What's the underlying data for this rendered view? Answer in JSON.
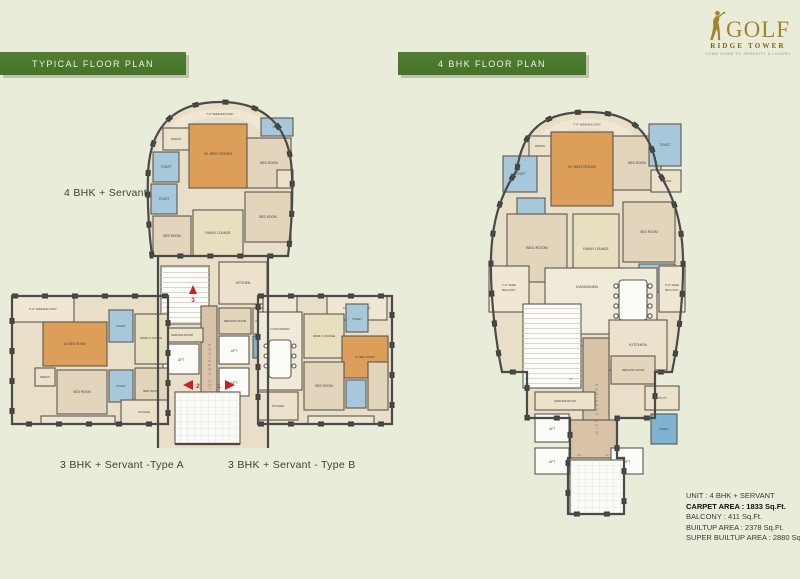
{
  "brand": {
    "title": "GOLF",
    "subtitle": "RIDGE TOWER",
    "tagline": "COME HOME TO SERENITY & LUXURY"
  },
  "headers": {
    "typical": "TYPICAL FLOOR PLAN",
    "four_bhk": "4 BHK FLOOR PLAN"
  },
  "unit_labels": {
    "top": "4 BHK + Servant",
    "type_a": "3 BHK + Servant -Type A",
    "type_b": "3 BHK + Servant - Type B"
  },
  "rooms": {
    "bed_room": "BED ROOM",
    "m_bed_room": "M. BED ROOM",
    "toilet": "TOILET",
    "dress": "DRESS",
    "family_lounge": "FAMILY LOUNGE",
    "living_dining": "LIVING/DINING",
    "kitchen": "KITCHEN",
    "servant_room": "SERVANT ROOM",
    "utility": "UTILITY",
    "service_room": "SERVICE ROOM",
    "lift": "LIFT",
    "wide_corridor": "WIDE CORRIDOR",
    "balcony_7": "7'-0\" WIDE BALCONY",
    "balcony_5": "5'-0\" WIDE BALCONY",
    "balcony_7a": "7'-0\" WIDE",
    "balcony_9a": "9'-0\" WIDE",
    "balcony_word": "BALCONY",
    "entrance_a": "5'-6\" WIDE",
    "entrance_b": "ENTRANCE",
    "up": "UP",
    "dn": "DN"
  },
  "markers": {
    "unit1": "1",
    "unit2": "2",
    "unit3": "3"
  },
  "specs": {
    "lines": [
      {
        "text": "UNIT : 4 BHK + SERVANT",
        "bold": false
      },
      {
        "text": "CARPET AREA : 1833 Sq.Ft.",
        "bold": true
      },
      {
        "text": "BALCONY : 411 Sq.Ft.",
        "bold": false
      },
      {
        "text": "BUILTUP AREA : 2378 Sq.Ft.",
        "bold": false
      },
      {
        "text": "SUPER BUILTUP AREA : 2880 Sq.Ft.",
        "bold": false
      }
    ]
  },
  "colors": {
    "background": "#e8ecd8",
    "bar_green": "#4c7a2f",
    "gold": "#a5832a",
    "wall": "#4a4a48",
    "toilet_blue": "#a7c8db",
    "master_orange": "#dd9e5a",
    "corridor_tan": "#d8c2a8",
    "marker_red": "#c62222"
  }
}
